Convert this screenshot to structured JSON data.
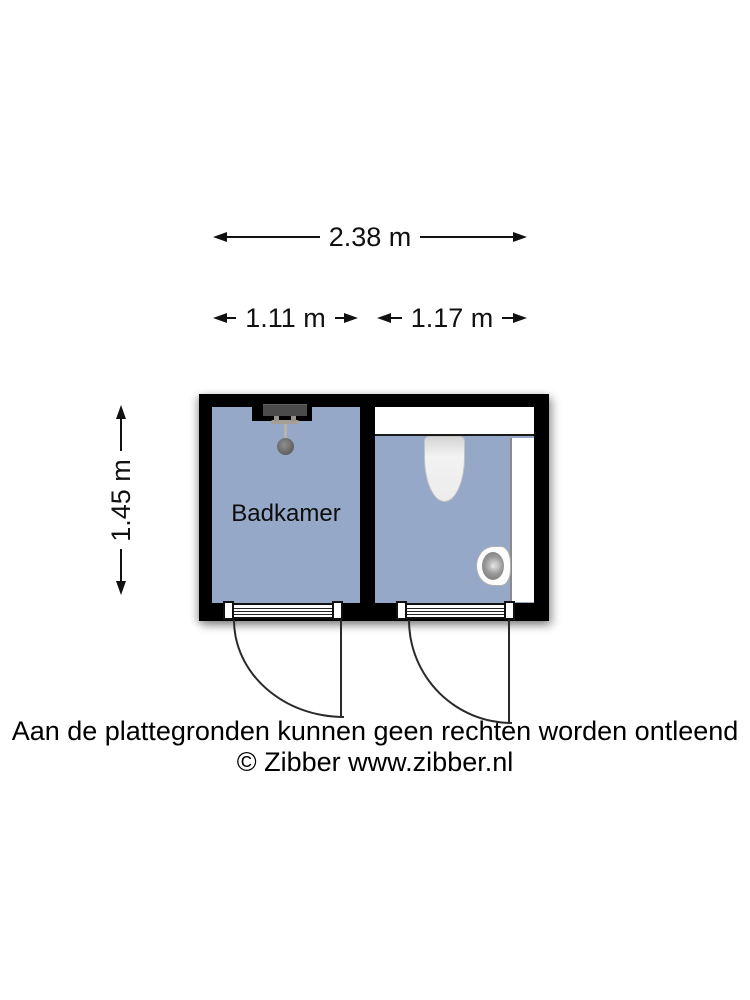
{
  "dimensions": {
    "overall_width": "2.38 m",
    "left_room_width": "1.11 m",
    "right_room_width": "1.17 m",
    "overall_depth": "1.45 m"
  },
  "floorplan": {
    "left_room": {
      "label": "Badkamer",
      "fixtures": [
        "shower"
      ]
    },
    "right_room": {
      "label": "",
      "fixtures": [
        "toilet",
        "sink",
        "counter"
      ]
    },
    "colors": {
      "floor": "#96a8c8",
      "wall": "#000000",
      "line": "#1a1a1a",
      "fixture": "#f1f1f1"
    }
  },
  "footer": {
    "disclaimer": "Aan de plattegronden kunnen geen rechten worden ontleend",
    "copyright": "© Zibber www.zibber.nl"
  }
}
